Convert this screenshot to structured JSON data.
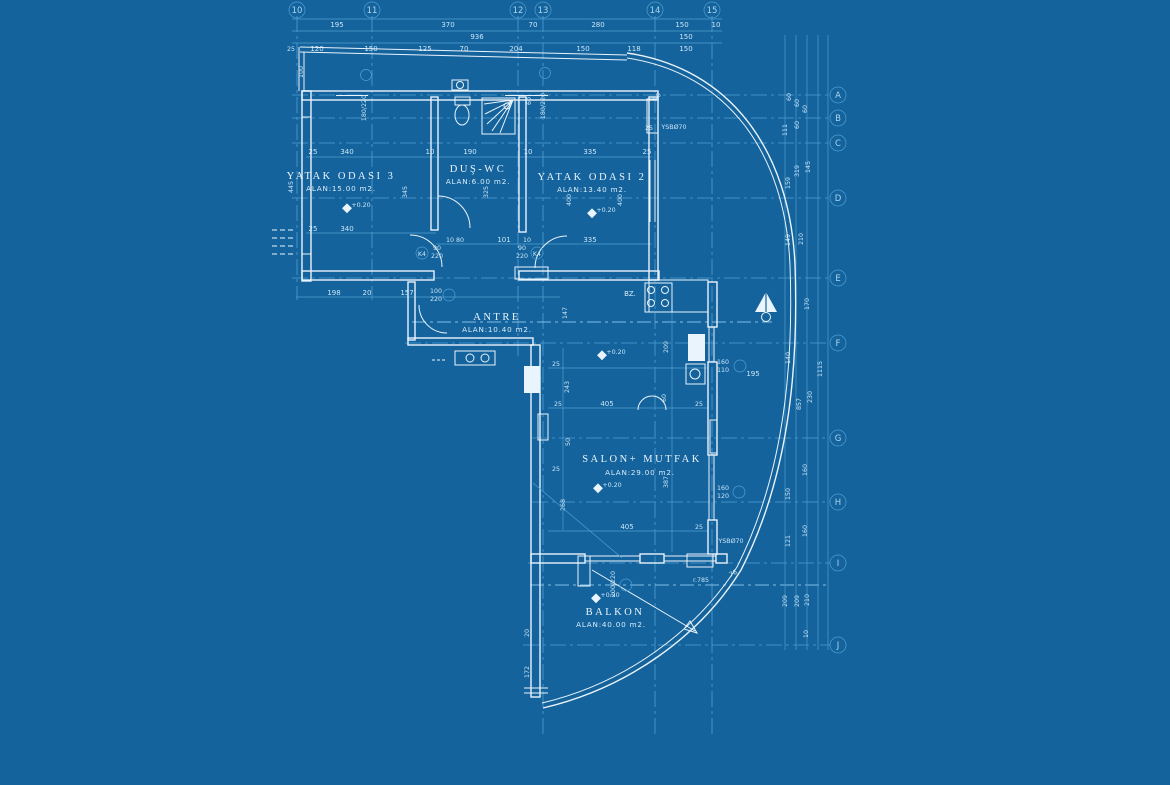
{
  "colors": {
    "background": "#15639C",
    "grid_line": "#4E9FD2",
    "bright_line": "#E9F4FC"
  },
  "grid_bubbles": {
    "top": [
      "10",
      "11",
      "12",
      "13",
      "14",
      "15"
    ],
    "right": [
      "A",
      "B",
      "C",
      "D",
      "E",
      "F",
      "G",
      "H",
      "I",
      "J"
    ]
  },
  "rooms": {
    "bedroom3": {
      "name": "YATAK ODASI 3",
      "area": "ALAN:15.00 m2."
    },
    "bath": {
      "name": "DUŞ-WC",
      "area": "ALAN:6.00 m2."
    },
    "bedroom2": {
      "name": "YATAK ODASI 2",
      "area": "ALAN:13.40 m2."
    },
    "hall": {
      "name": "ANTRE",
      "area": "ALAN:10.40 m2."
    },
    "living": {
      "name": "SALON+ MUTFAK",
      "area": "ALAN:29.00 m2."
    },
    "balcony": {
      "name": "BALKON",
      "area": "ALAN:40.00 m2."
    }
  },
  "annotations": {
    "bz": "BZ.",
    "ysb_top": "YSBØ70",
    "ysb_bottom": "YSBØ70",
    "radius": "r.785",
    "curve_dim": "76",
    "curve_dim_top": "20",
    "elevation": "+0.20"
  },
  "doors": {
    "k4": "K4",
    "size_w": "90",
    "size_h": "220",
    "entry_w": "100",
    "entry_h": "220"
  },
  "windows": {
    "top1": "180/220",
    "top2": "180/220",
    "kitchen_w": "160",
    "kitchen_h": "110",
    "salon_w": "160",
    "salon_h": "120",
    "balcony": "200/220"
  },
  "dims": {
    "top1": [
      "195",
      "370",
      "70",
      "280",
      "150",
      "10"
    ],
    "top2": [
      "936",
      "150"
    ],
    "top3": [
      "25",
      "120",
      "150",
      "125",
      "70",
      "204",
      "150",
      "118",
      "150"
    ],
    "room_top": [
      "25",
      "340",
      "10",
      "190",
      "10",
      "335",
      "25"
    ],
    "room_bot": [
      "25",
      "340",
      "10 80",
      "101",
      "10",
      "335"
    ],
    "left_bot": [
      "198",
      "20",
      "157"
    ],
    "vleft": [
      "100",
      "445",
      "345",
      "325",
      "60",
      "400",
      "400"
    ],
    "vmid": [
      "147",
      "243",
      "50",
      "268",
      "387",
      "209",
      "60",
      "20",
      "172",
      "25"
    ],
    "salon": [
      "25",
      "25",
      "405",
      "25",
      "405",
      "25",
      "195",
      "25"
    ],
    "right_col": [
      "60",
      "60",
      "60",
      "111",
      "60",
      "319",
      "145",
      "159",
      "149",
      "210",
      "170",
      "140",
      "1115",
      "230",
      "857",
      "160",
      "150",
      "160",
      "121",
      "209",
      "209",
      "210",
      "10"
    ]
  }
}
